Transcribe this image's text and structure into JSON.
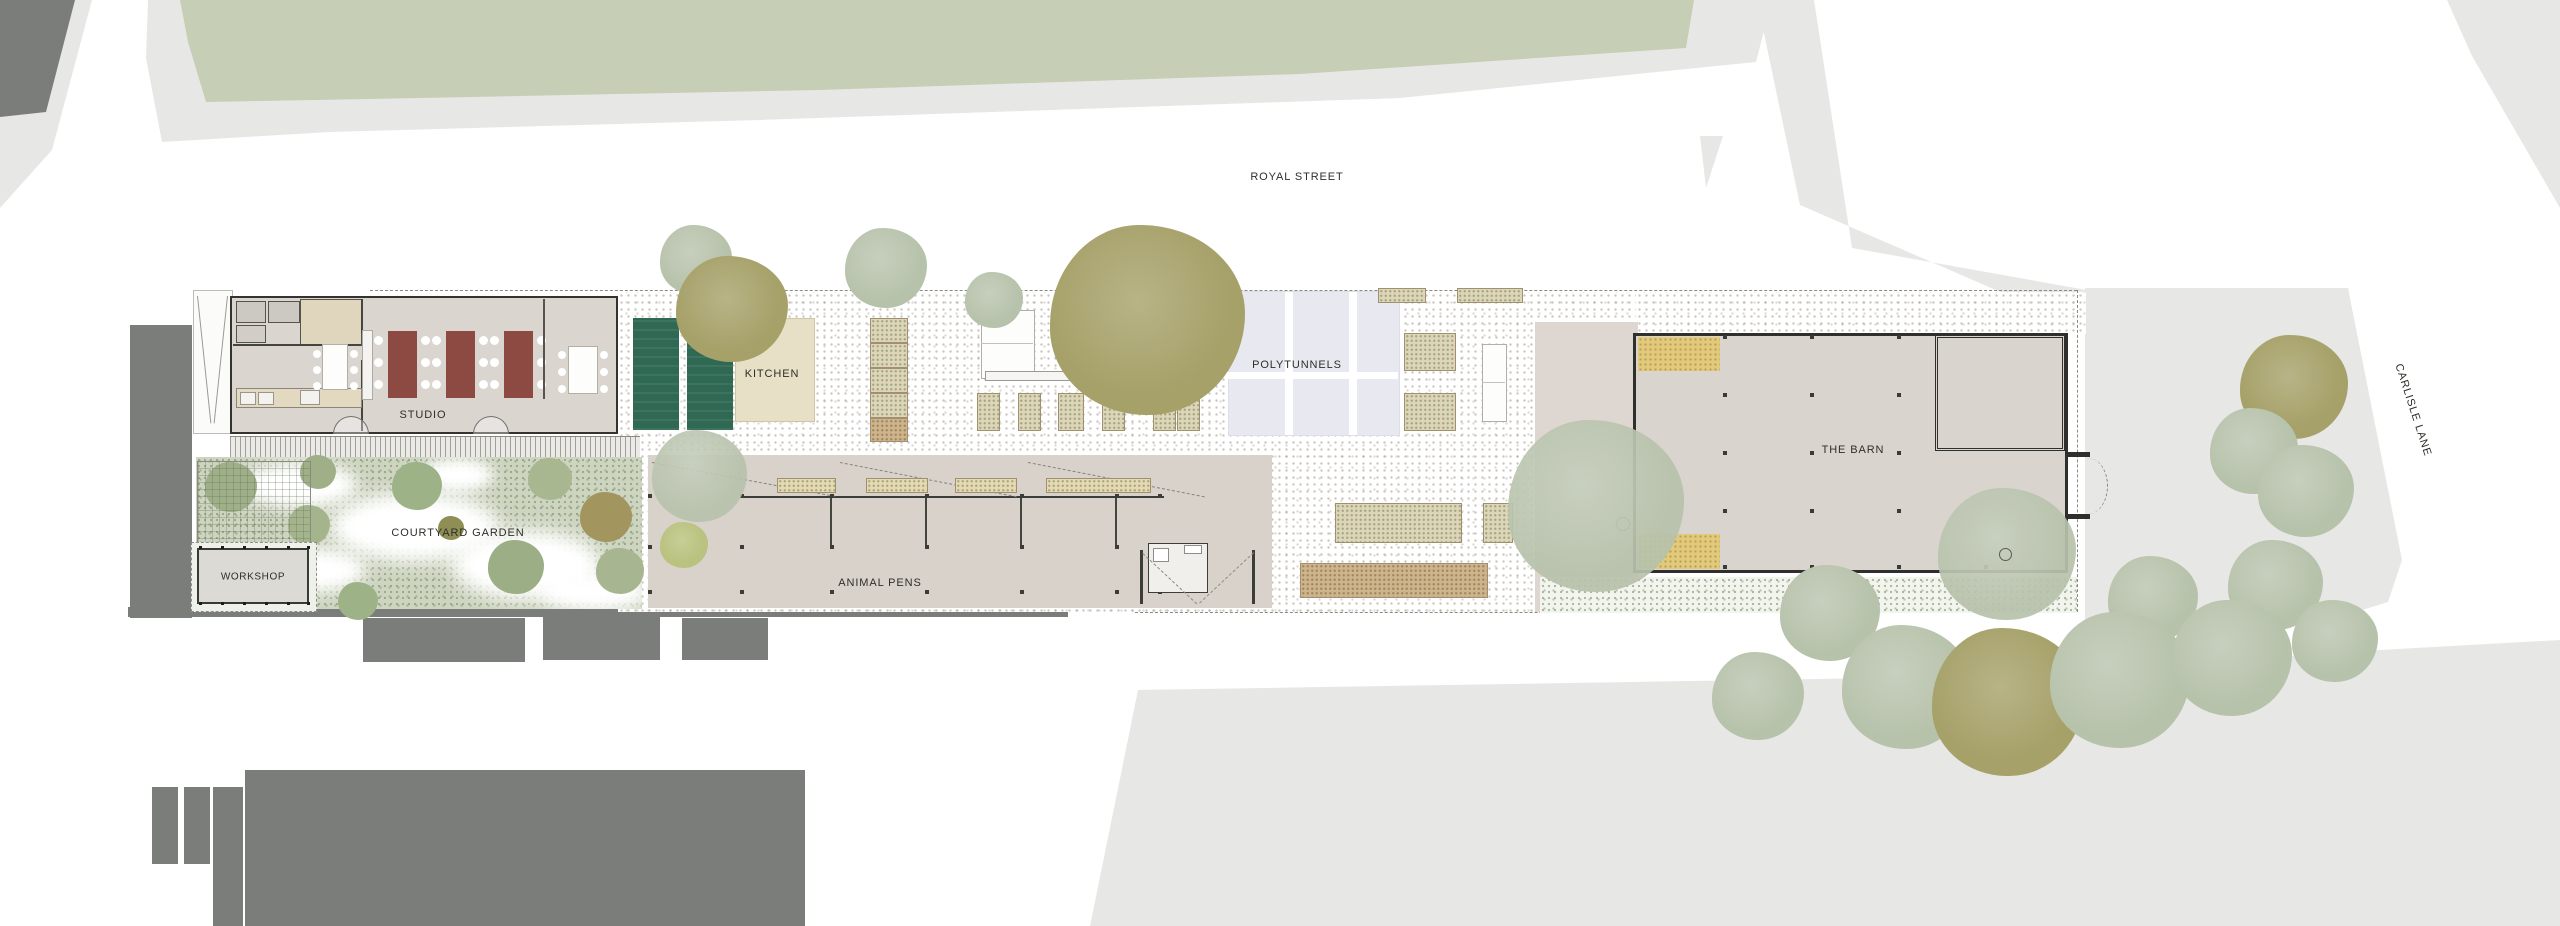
{
  "plan": {
    "streets": {
      "royal": "ROYAL STREET",
      "carlisle": "CARLISLE LANE"
    },
    "areas": {
      "studio": "STUDIO",
      "kitchen": "KITCHEN",
      "courtyard_garden": "COURTYARD GARDEN",
      "workshop": "WORKSHOP",
      "animal_pens": "ANIMAL PENS",
      "polytunnels": "POLYTUNNELS",
      "barn": "THE BARN"
    },
    "colors": {
      "road": "#e7e8e6",
      "field": "#c6ceb6",
      "ctx": "#7a7d7a",
      "floor": "#dad5cf",
      "wall": "#34342f",
      "red": "#8c4a42",
      "beige": "#e7dfc6",
      "gpanel": "#2f6853",
      "tunnel": "#e8e8f1",
      "straw": "#e2ca7c",
      "sage": "#b7c2ab",
      "olive": "#a6a169",
      "garden": "#cdd4c0",
      "pink": "#ded6d1",
      "pens": "#d8d2cb"
    }
  }
}
